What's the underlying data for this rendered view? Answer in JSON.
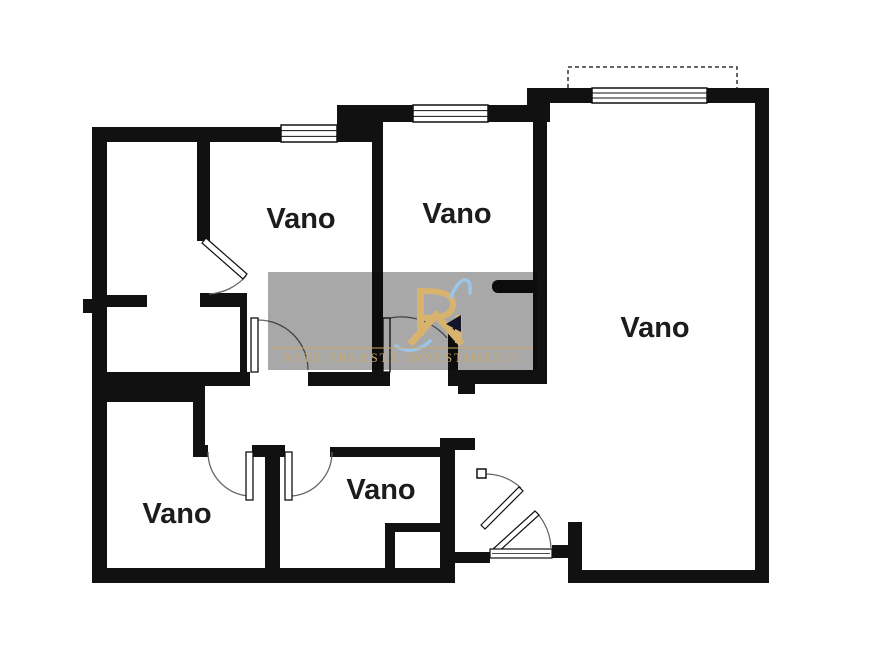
{
  "floorplan": {
    "title": "apartment-floorplan",
    "colors": {
      "background": "#ffffff",
      "wall": "#111111",
      "label": "#1c1c1c",
      "door_arc": "#666666",
      "window_stroke": "#111111",
      "balcony_dash": "#333333"
    },
    "room_labels": [
      {
        "text": "Vano",
        "x": 301,
        "y": 228
      },
      {
        "text": "Vano",
        "x": 457,
        "y": 223
      },
      {
        "text": "Vano",
        "x": 655,
        "y": 337
      },
      {
        "text": "Vano",
        "x": 177,
        "y": 523
      },
      {
        "text": "Vano",
        "x": 381,
        "y": 499
      }
    ],
    "walls": [
      [
        92,
        127,
        15,
        456
      ],
      [
        83,
        299,
        9,
        14
      ],
      [
        92,
        127,
        280,
        15
      ],
      [
        337,
        105,
        35,
        37
      ],
      [
        337,
        105,
        203,
        17
      ],
      [
        527,
        88,
        23,
        34
      ],
      [
        527,
        88,
        242,
        15
      ],
      [
        755,
        88,
        14,
        495
      ],
      [
        568,
        570,
        201,
        13
      ],
      [
        568,
        522,
        14,
        61
      ],
      [
        552,
        545,
        16,
        13
      ],
      [
        92,
        568,
        363,
        15
      ],
      [
        440,
        552,
        50,
        11
      ],
      [
        440,
        552,
        15,
        31
      ],
      [
        440,
        438,
        15,
        125
      ],
      [
        455,
        438,
        20,
        12
      ],
      [
        372,
        122,
        11,
        264
      ],
      [
        197,
        142,
        13,
        99
      ],
      [
        200,
        293,
        47,
        14
      ],
      [
        240,
        295,
        7,
        91
      ],
      [
        106,
        295,
        41,
        12
      ],
      [
        92,
        372,
        158,
        14
      ],
      [
        92,
        386,
        113,
        16
      ],
      [
        193,
        402,
        12,
        45
      ],
      [
        308,
        372,
        64,
        14
      ],
      [
        383,
        372,
        7,
        14
      ],
      [
        448,
        328,
        10,
        58
      ],
      [
        458,
        370,
        89,
        14
      ],
      [
        458,
        384,
        17,
        10
      ],
      [
        533,
        102,
        14,
        276
      ],
      [
        193,
        445,
        15,
        12
      ],
      [
        252,
        445,
        33,
        12
      ],
      [
        265,
        445,
        15,
        138
      ],
      [
        330,
        447,
        125,
        10
      ],
      [
        385,
        523,
        67,
        9
      ],
      [
        385,
        532,
        10,
        48
      ]
    ],
    "round_stub": [
      492,
      280,
      46,
      13
    ],
    "windows": [
      {
        "x": 281,
        "y": 125,
        "w": 56,
        "h": 17
      },
      {
        "x": 413,
        "y": 105,
        "w": 75,
        "h": 17
      },
      {
        "x": 592,
        "y": 88,
        "w": 115,
        "h": 15
      }
    ],
    "balcony": {
      "x1": 568,
      "y1": 67,
      "x2": 737,
      "y2": 88
    },
    "doors": {
      "arcs": [
        "M246 276 A53 53 0 0 1 209 294",
        "M258 320 A50 50 0 0 1 308 370",
        "M390 318 A60 60 0 0 1 447 338",
        "M208 452 A44 44 0 0 0 249 496",
        "M332 452 A44 44 0 0 1 292 496",
        "M487 474 A53 53 0 0 1 521 488",
        "M537 513 A58 58 0 0 1 551 548"
      ],
      "leaves_rect": [
        [
          251,
          318,
          7,
          54
        ],
        [
          383,
          318,
          7,
          54
        ],
        [
          246,
          452,
          7,
          48
        ],
        [
          285,
          452,
          7,
          48
        ]
      ],
      "leaves_quad": [
        "M206 238 L247 274 L243 279 L202 243 Z",
        "M481 525 L519 487 L523 491 L485 529 Z",
        "M492 550 L535 511 L539 515 L496 554 Z"
      ],
      "jamb_squares": [
        [
          477,
          469,
          9,
          9
        ]
      ],
      "threshold": [
        490,
        549,
        62,
        9
      ]
    },
    "watermark": {
      "box": [
        268,
        272,
        269,
        98
      ],
      "box_color": "#a8a8a8",
      "gold": "#d7b36e",
      "text_gold": "#c9a96a",
      "blue": "#9cc6e8",
      "dark": "#14142a",
      "rule_y": 348,
      "text": "ASTE·PREASTE·INVESTIMENTI",
      "text_x": 402,
      "text_y": 362,
      "logo": {
        "bar_left": [
          417,
          288,
          7,
          48
        ],
        "bar_right": [
          455,
          315,
          7,
          28
        ],
        "bowl": "M424 291 C448 291 453 297 453 304 C453 312 448 318 424 318",
        "chevron": "M410 344 L436 315 L462 344",
        "triangle": "M446 324 L461 315 L461 332 Z",
        "swoosh_top": "M451 297 C458 278 472 272 470 293",
        "swoosh_bottom": "M396 346 C406 353 420 351 430 341"
      }
    }
  }
}
